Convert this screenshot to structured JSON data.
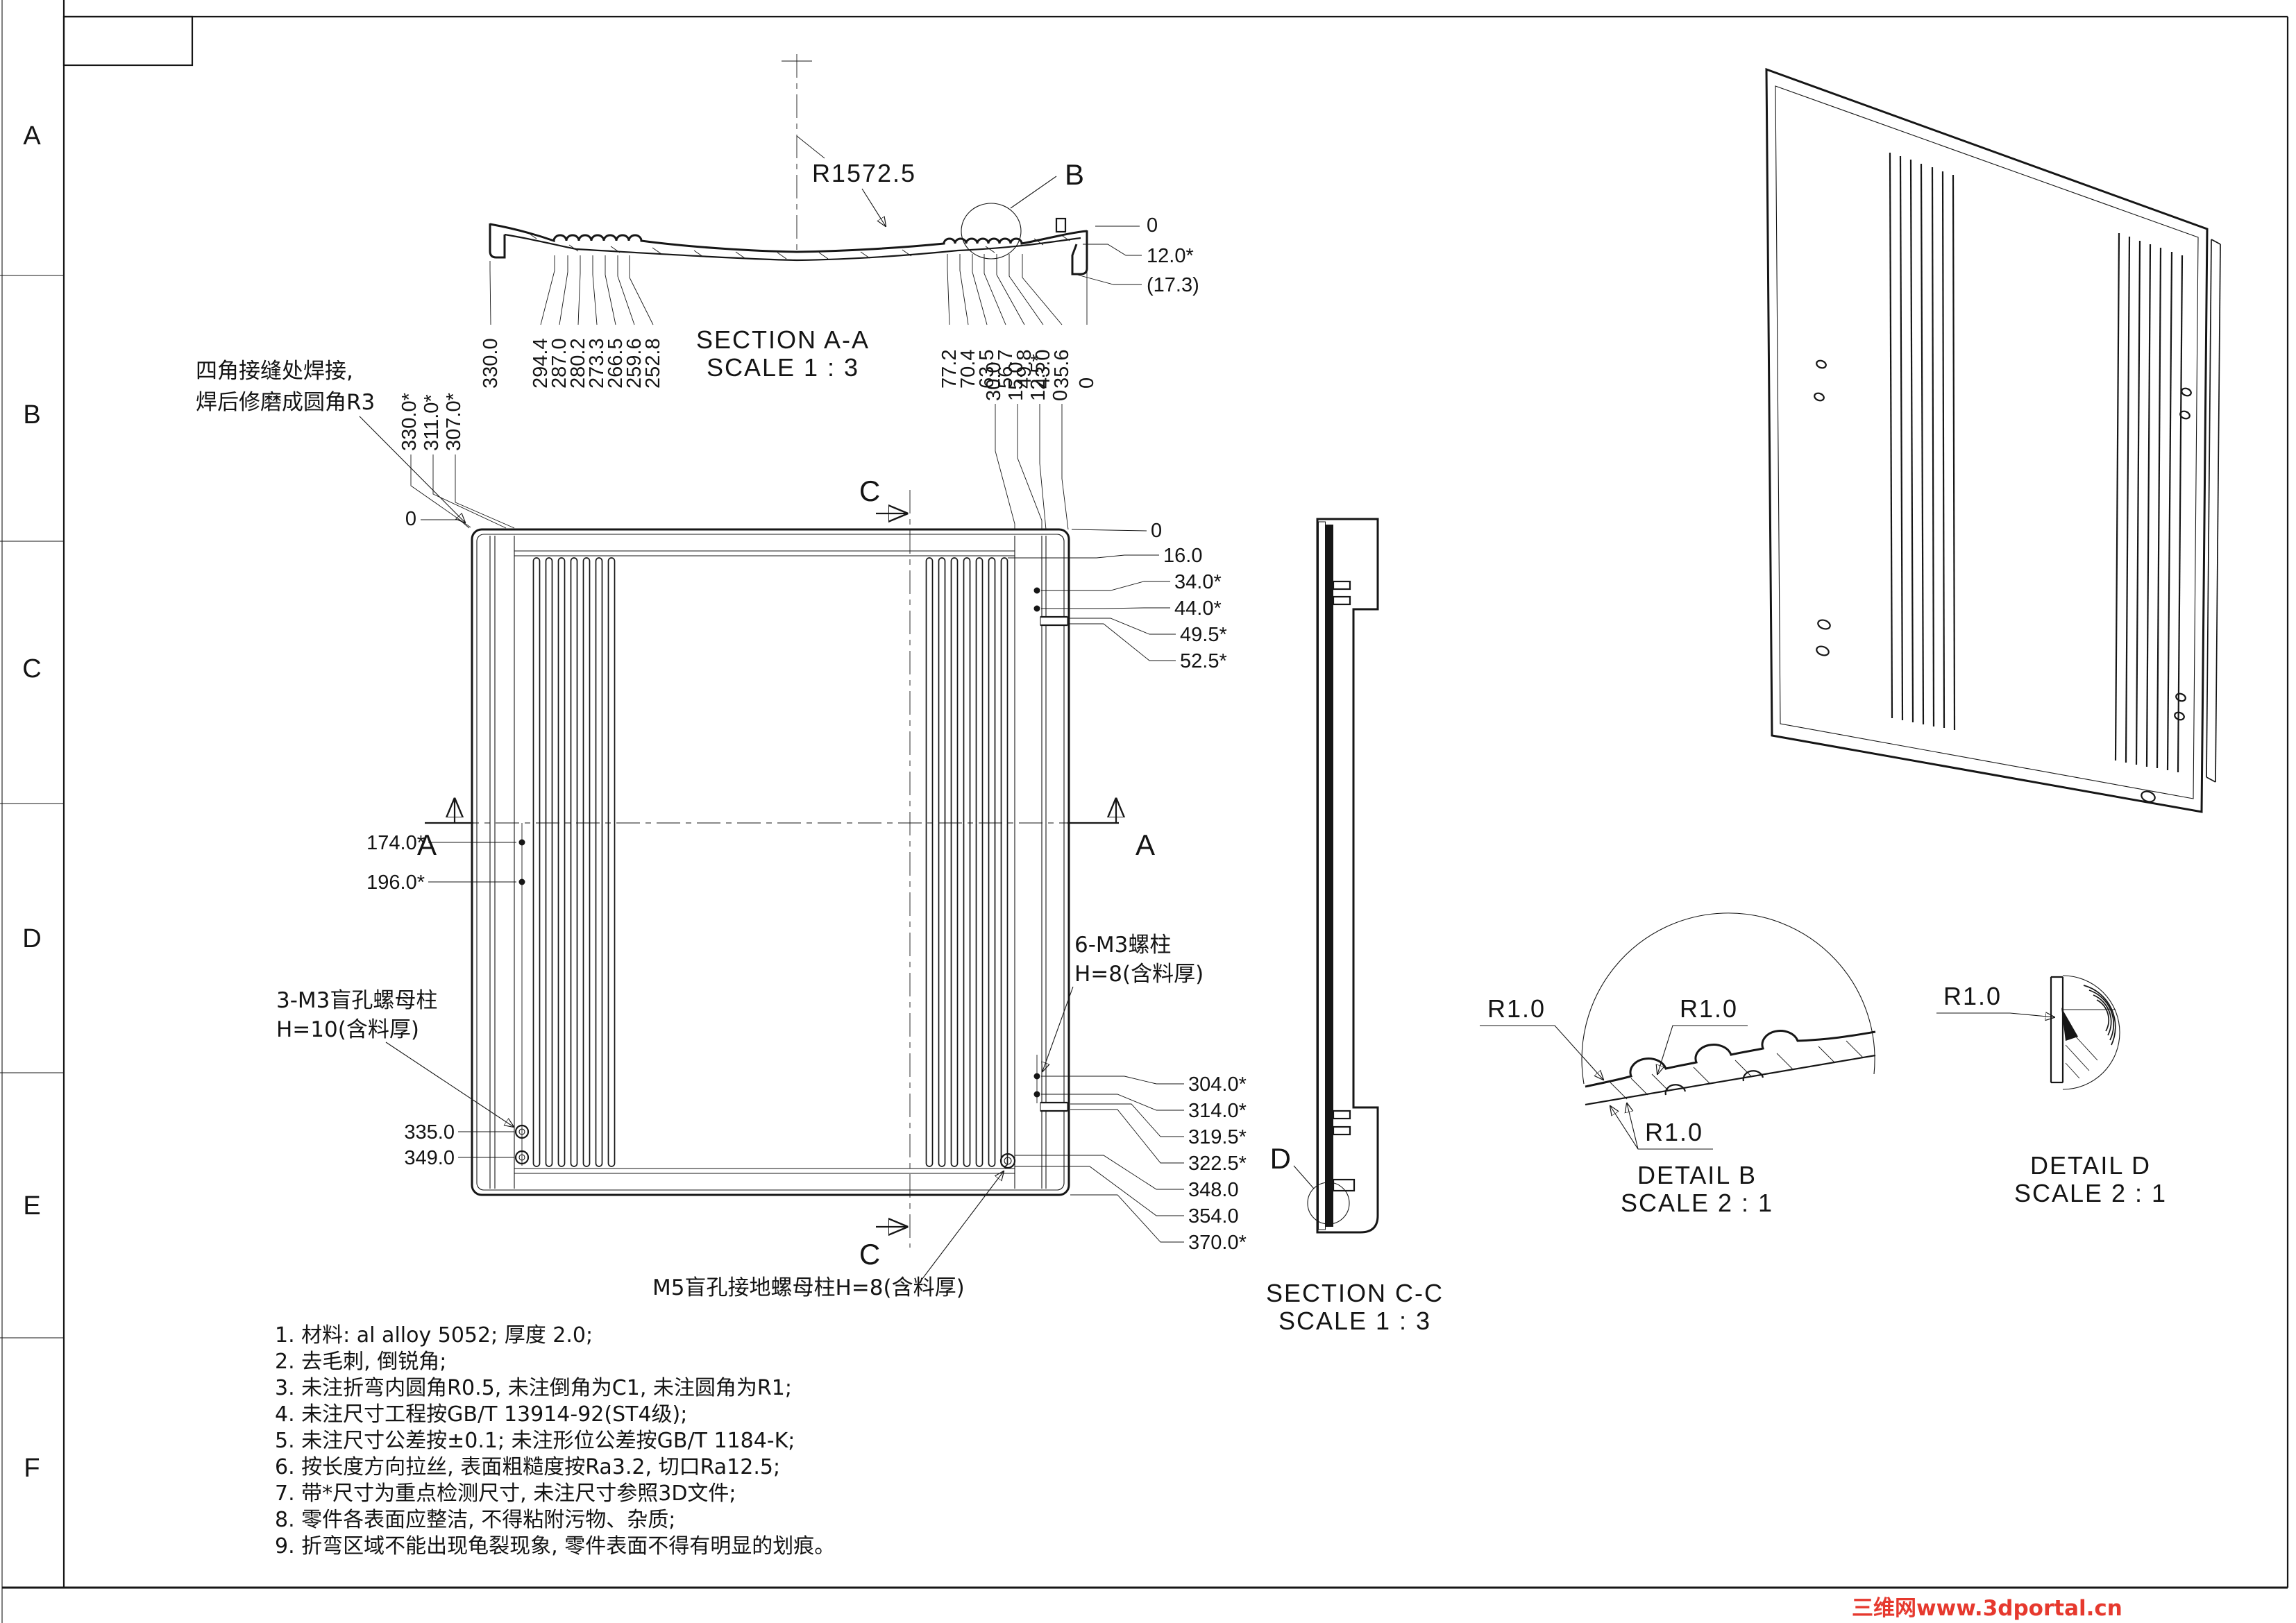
{
  "sheet": {
    "zones": [
      "A",
      "B",
      "C",
      "D",
      "E",
      "F"
    ],
    "watermark": "三维网www.3dportal.cn"
  },
  "section_aa": {
    "title": "SECTION A-A",
    "scale": "SCALE 1 : 3",
    "radius": "R1572.5",
    "detail_ref": "B",
    "left_dims": [
      "330.0",
      "294.4",
      "287.0",
      "280.2",
      "273.3",
      "266.5",
      "259.6",
      "252.8"
    ],
    "right_dims": [
      "77.2",
      "70.4",
      "63.5",
      "56.7",
      "49.8",
      "43.0",
      "35.6",
      "0"
    ],
    "end_dims": [
      "0",
      "12.0*",
      "(17.3)"
    ]
  },
  "front": {
    "weld_note": [
      "四角接缝处焊接,",
      "焊后修磨成圆角R3"
    ],
    "zero": "0",
    "top_left_dims": [
      "330.0*",
      "311.0*",
      "307.0*"
    ],
    "top_right_dims": [
      "30.0",
      "15.0",
      "12.5*",
      "0"
    ],
    "right_upper_dims": [
      "0",
      "16.0",
      "34.0*",
      "44.0*",
      "49.5*",
      "52.5*"
    ],
    "right_lower_dims": [
      "304.0*",
      "314.0*",
      "319.5*",
      "322.5*",
      "348.0",
      "354.0",
      "370.0*"
    ],
    "left_mid_dims": [
      "174.0*",
      "196.0*"
    ],
    "left_lower_dims": [
      "335.0",
      "349.0"
    ],
    "note_m3_left": [
      "3-M3盲孔螺母柱",
      "H=10(含料厚)"
    ],
    "note_m3_right": [
      "6-M3螺柱",
      "H=8(含料厚)"
    ],
    "note_m5": "M5盲孔接地螺母柱H=8(含料厚)",
    "marker_a": "A",
    "marker_c": "C"
  },
  "section_cc": {
    "title": "SECTION C-C",
    "scale": "SCALE 1 : 3",
    "detail_ref": "D"
  },
  "detail_b": {
    "title": "DETAIL B",
    "scale": "SCALE 2 : 1",
    "radii": [
      "R1.0",
      "R1.0",
      "R1.0"
    ]
  },
  "detail_d": {
    "title": "DETAIL D",
    "scale": "SCALE 2 : 1",
    "radius": "R1.0"
  },
  "notes": [
    "1.  材料: al alloy 5052;  厚度 2.0;",
    "2.  去毛刺, 倒锐角;",
    "3.  未注折弯内圆角R0.5, 未注倒角为C1, 未注圆角为R1;",
    "4.  未注尺寸工程按GB/T 13914-92(ST4级);",
    "5.  未注尺寸公差按±0.1;  未注形位公差按GB/T 1184-K;",
    "6.  按长度方向拉丝, 表面粗糙度按Ra3.2, 切口Ra12.5;",
    "7.  带*尺寸为重点检测尺寸, 未注尺寸参照3D文件;",
    "8.  零件各表面应整洁, 不得粘附污物、杂质;",
    "9.  折弯区域不能出现龟裂现象, 零件表面不得有明显的划痕。"
  ]
}
